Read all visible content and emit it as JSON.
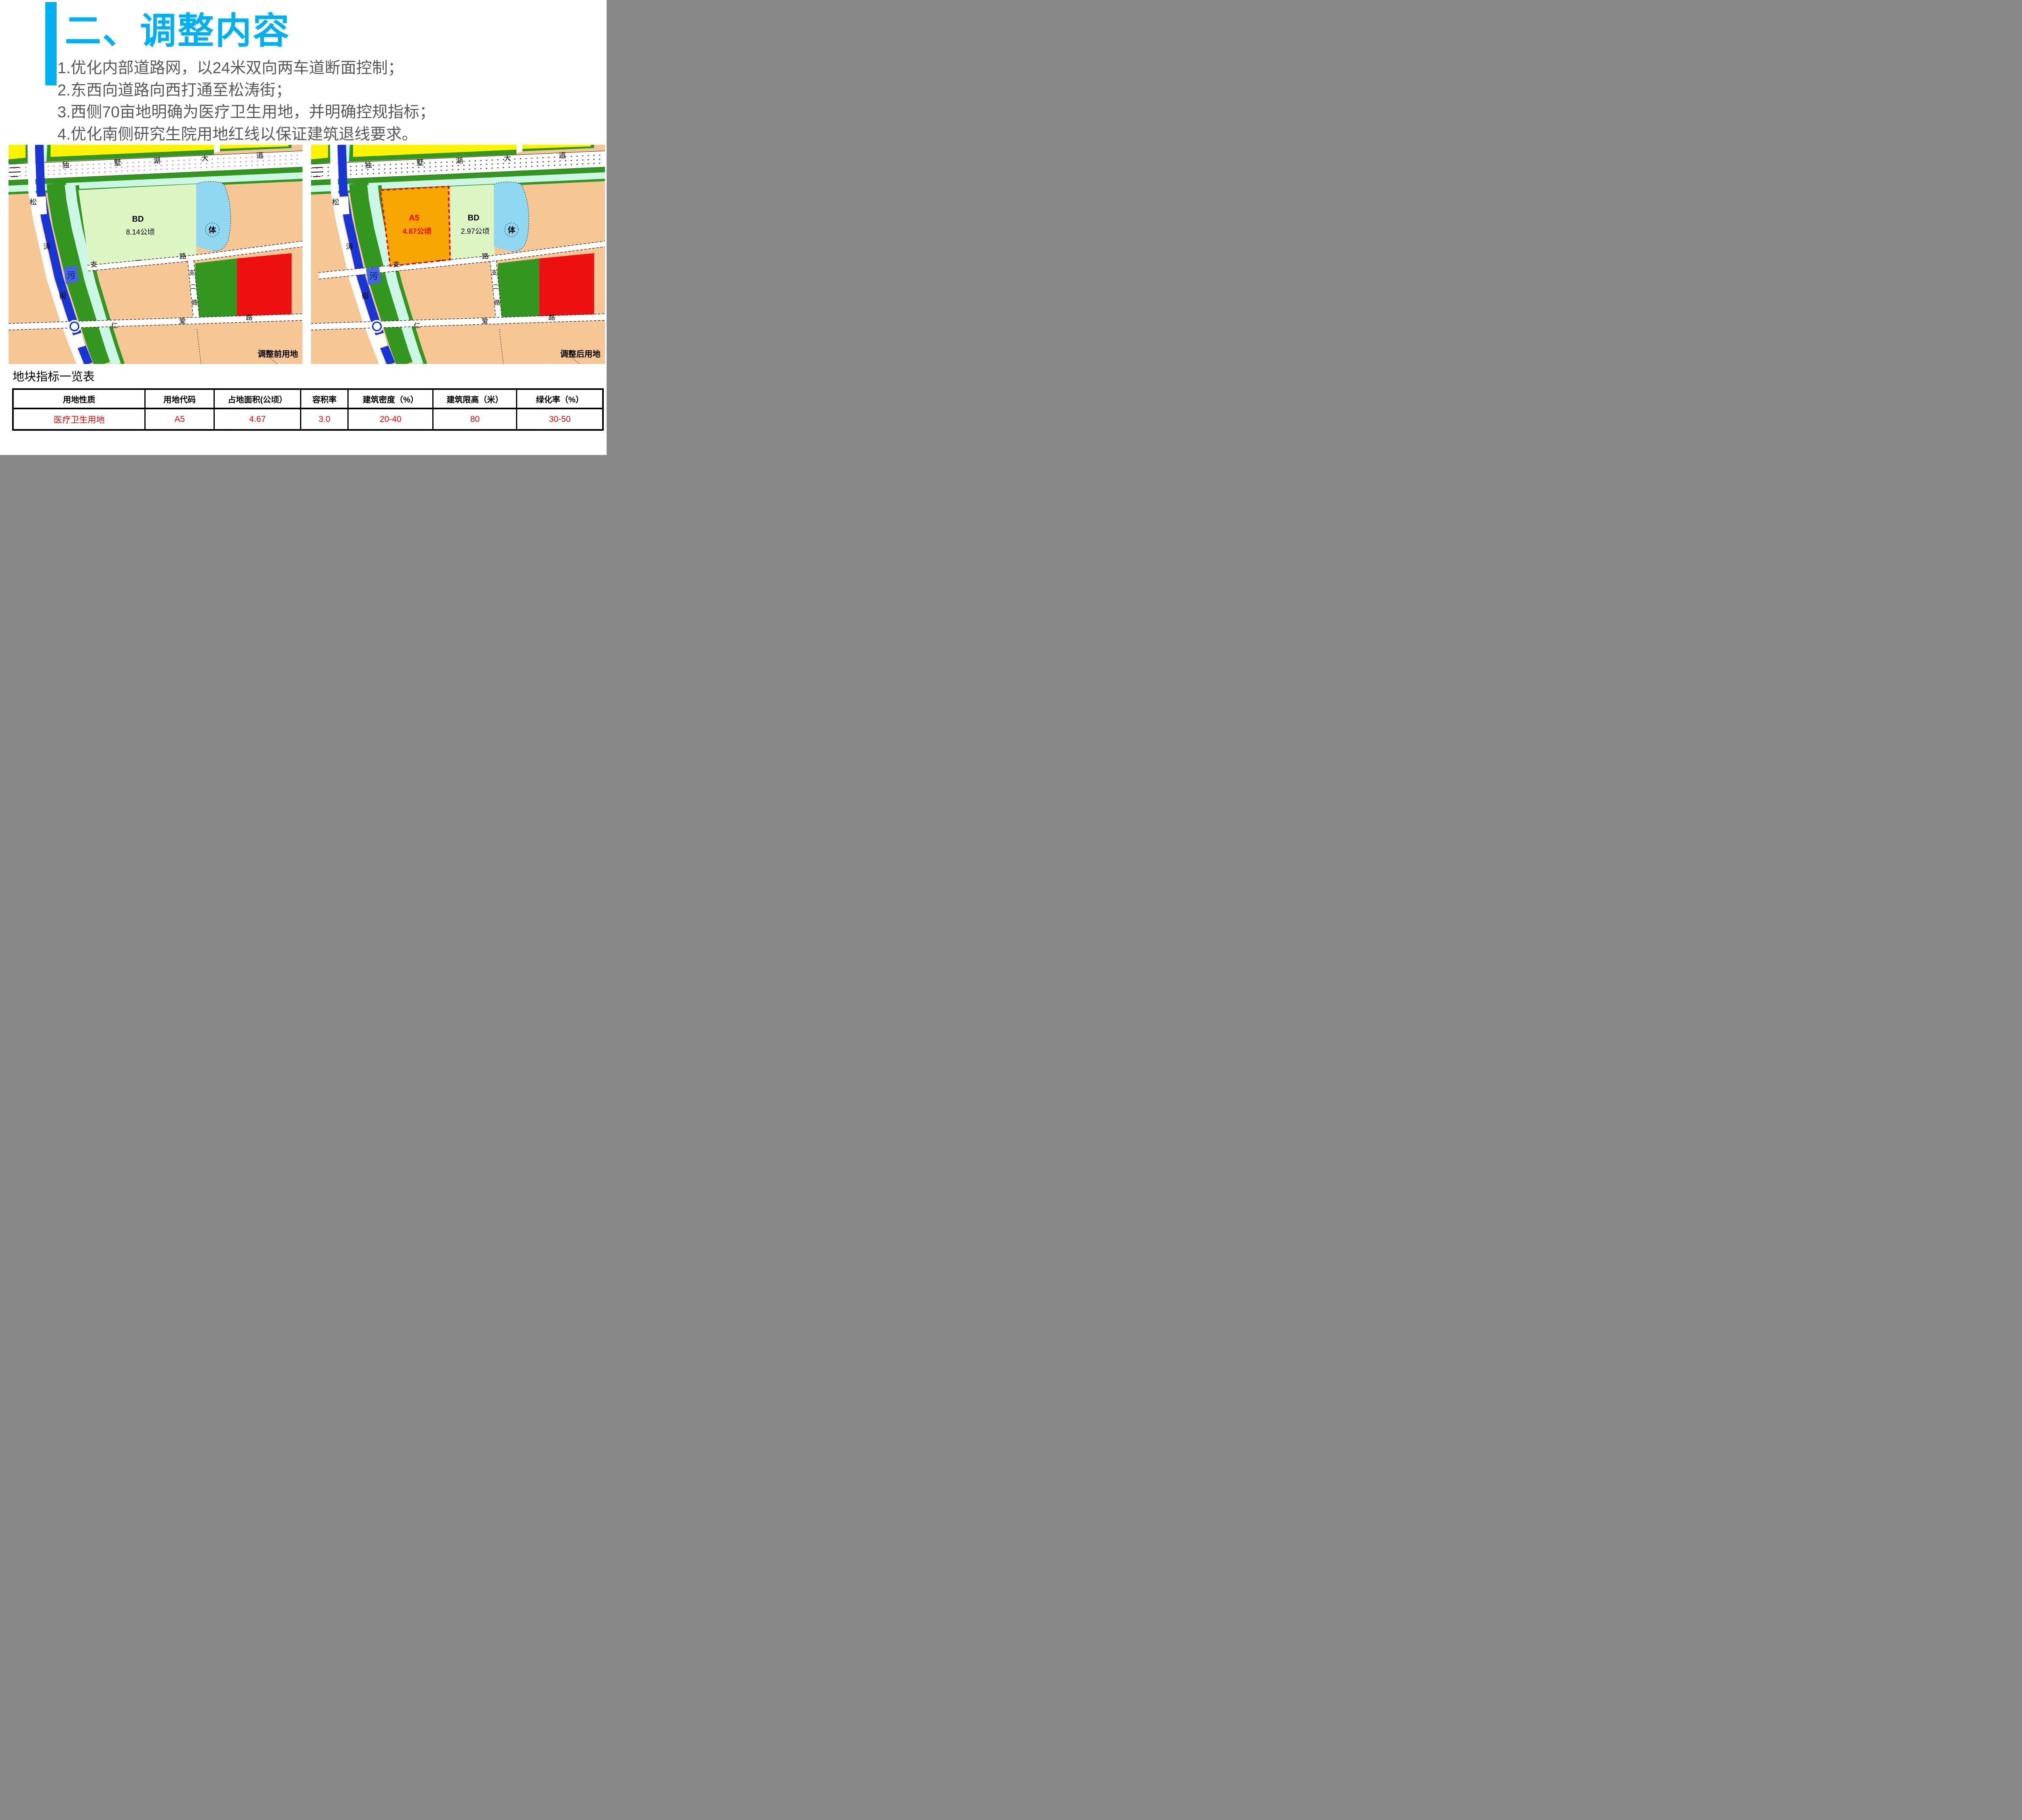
{
  "page": {
    "title": "二、调整内容"
  },
  "bullets": [
    "1.优化内部道路网，以24米双向两车道断面控制；",
    "2.东西向道路向西打通至松涛街；",
    "3.西侧70亩地明确为医疗卫生用地，并明确控规指标；",
    "4.优化南侧研究生院用地红线以保证建筑退线要求。"
  ],
  "maps": {
    "roads": {
      "dushuhu": [
        "独",
        "墅",
        "湖",
        "大",
        "道"
      ],
      "songtao": [
        "松",
        "涛",
        "街"
      ],
      "zhiyi": [
        "支",
        "一",
        "路"
      ],
      "zhier": [
        "支",
        "二",
        "路"
      ],
      "renai": [
        "仁",
        "爱",
        "路"
      ]
    },
    "labels": {
      "pond": "体",
      "sewage": "污"
    },
    "before": {
      "caption": "调整前用地",
      "bd_code": "BD",
      "bd_area": "8.14公顷"
    },
    "after": {
      "caption": "调整后用地",
      "a5_code": "A5",
      "a5_area": "4.67公顷",
      "bd_code": "BD",
      "bd_area": "2.97公顷"
    }
  },
  "table": {
    "title": "地块指标一览表",
    "headers": [
      "用地性质",
      "用地代码",
      "占地面积(公顷）",
      "容积率",
      "建筑密度（%）",
      "建筑限高（米）",
      "绿化率（%）"
    ],
    "rows": [
      [
        "医疗卫生用地",
        "A5",
        "4.67",
        "3.0",
        "20-40",
        "80",
        "30-50"
      ]
    ]
  },
  "colors": {
    "accent": "#00B0F0",
    "body_text": "#595959",
    "value_red": "#FF0000",
    "peach": "#F6C794",
    "yellow": "#FCF201",
    "green": "#33971F",
    "pale_cyan": "#CCF7E6",
    "pale_green": "#DCF5C2",
    "pond": "#90D7F2",
    "canal": "#1A35D6",
    "red_parcel": "#EE1010",
    "orange": "#F7A700",
    "sewage_bg": "#4468DC",
    "sewage_text": "#15289B",
    "outline_red": "#FF0000",
    "dots_before": "#C878C8",
    "dots_after": "#3A3A3A"
  }
}
